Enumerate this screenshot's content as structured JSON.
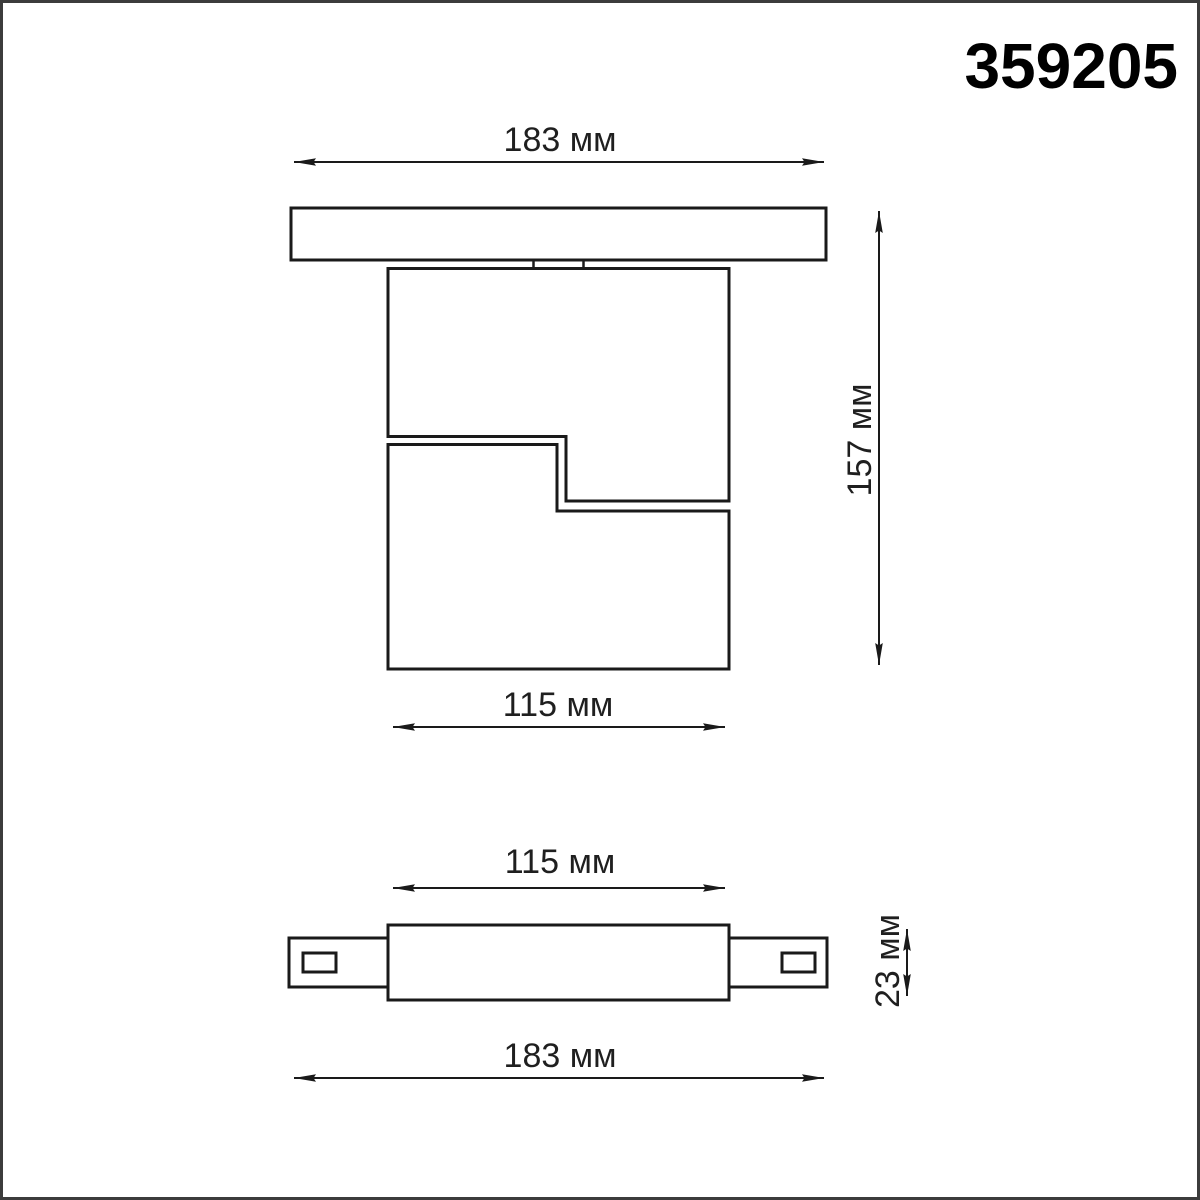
{
  "page": {
    "product_code": "359205",
    "background_color": "#ffffff",
    "frame_color": "#3c3c3c",
    "line_color": "#1a1a1a"
  },
  "side_view": {
    "description": "Side projection of track-mounted luminaire",
    "dim_track_width": "183 мм",
    "dim_total_height": "157 мм",
    "dim_body_width": "115 мм"
  },
  "bottom_view": {
    "description": "Bottom projection of track connector",
    "dim_body_width": "115 мм",
    "dim_connector_height": "23 мм",
    "dim_track_width": "183 мм"
  }
}
